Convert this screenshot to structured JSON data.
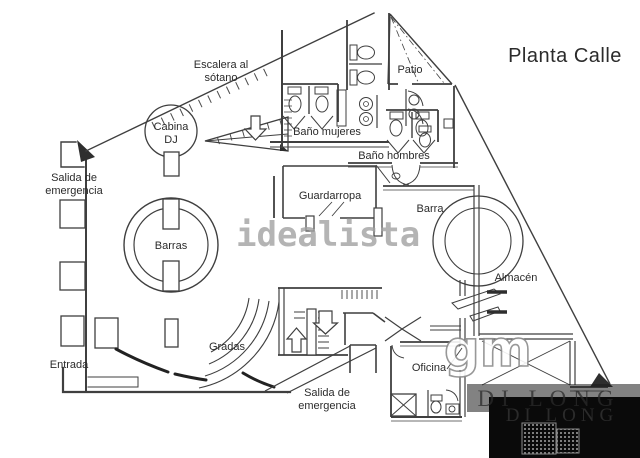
{
  "title": "Planta Calle",
  "rooms": {
    "escalera_sotano": {
      "line1": "Escalera al",
      "line2": "sótano"
    },
    "cabina_dj": {
      "line1": "Cabina",
      "line2": "DJ"
    },
    "salida_emergencia_superior": {
      "line1": "Salida de",
      "line2": "emergencia"
    },
    "patio": "Patio",
    "bano_mujeres": "Baño mujeres",
    "bano_hombres": "Baño hombres",
    "guardarropa": "Guardarropa",
    "barra": "Barra",
    "barras": "Barras",
    "almacen": "Almacén",
    "gradas": "Gradas",
    "entrada": "Entrada",
    "oficina": "Oficina",
    "salida_emergencia_inferior": {
      "line1": "Salida de",
      "line2": "emergencia"
    }
  },
  "watermarks": {
    "idealista": "idealista",
    "gm": "gm",
    "dilong_banner": "DI LONG",
    "dilong_box": "DI LONG"
  },
  "colors": {
    "wall": "#3f3f3f",
    "wall_dark": "#2e2e2e",
    "label": "#2b2b2b",
    "background": "#ffffff",
    "watermark_gray": "#a2a2a2",
    "watermark_box": "#0a0a0a"
  }
}
